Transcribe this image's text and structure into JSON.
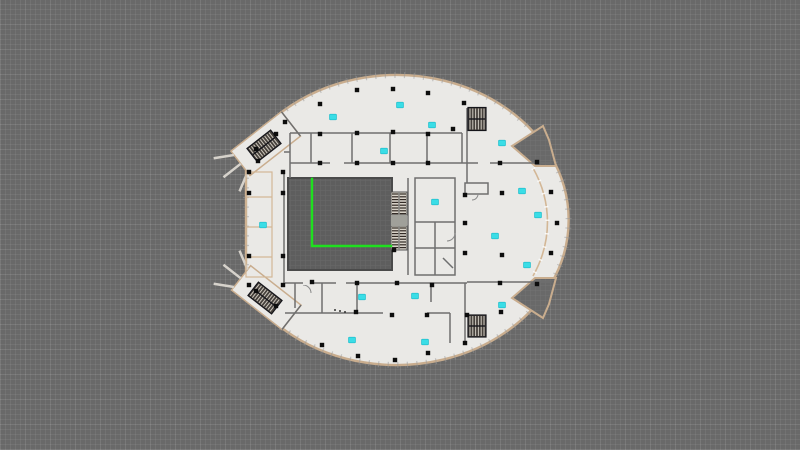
{
  "meta": {
    "view": "floor-plan-canvas",
    "description": "Elliptical building floor plan viewed top-down on a gray grid drafting canvas"
  },
  "colors": {
    "canvas_bg": "#696969",
    "grid_line": "#747474",
    "floor": "#eae9e6",
    "rim": "#c9ad8e",
    "wall": "#6f6f6f",
    "wall_dark": "#4e4e4e",
    "tan_room": "#d3b796",
    "void_fill": "#5e5e5e",
    "column": "#0d0d0d",
    "sensor": "#3adde6",
    "route": "#1fe01f",
    "stair_base": "#46413c",
    "stair_tread": "#cfc9bf",
    "escalator_base": "#d8d2c8",
    "escalator_tread": "#332b26",
    "landing": "#a0a09a",
    "tick": "#9a9a9a"
  },
  "building": {
    "cx": 397,
    "cy": 220,
    "rx": 172,
    "ry": 145,
    "chord": {
      "x": 246,
      "y1": 150,
      "y2": 290
    }
  },
  "atrium_void": {
    "x": 288,
    "y": 178,
    "w": 104,
    "h": 92
  },
  "route": {
    "points": [
      [
        312,
        179
      ],
      [
        312,
        246
      ],
      [
        391,
        246
      ]
    ]
  },
  "columns": [
    [
      320,
      104
    ],
    [
      357,
      90
    ],
    [
      393,
      89
    ],
    [
      428,
      93
    ],
    [
      464,
      103
    ],
    [
      285,
      122
    ],
    [
      453,
      129
    ],
    [
      320,
      134
    ],
    [
      357,
      133
    ],
    [
      393,
      132
    ],
    [
      428,
      134
    ],
    [
      258,
      161
    ],
    [
      256,
      149
    ],
    [
      276,
      134
    ],
    [
      320,
      163
    ],
    [
      357,
      163
    ],
    [
      393,
      163
    ],
    [
      428,
      163
    ],
    [
      500,
      163
    ],
    [
      537,
      162
    ],
    [
      249,
      172
    ],
    [
      283,
      172
    ],
    [
      249,
      193
    ],
    [
      283,
      193
    ],
    [
      249,
      256
    ],
    [
      283,
      256
    ],
    [
      465,
      195
    ],
    [
      502,
      193
    ],
    [
      551,
      192
    ],
    [
      465,
      223
    ],
    [
      557,
      223
    ],
    [
      394,
      250
    ],
    [
      465,
      253
    ],
    [
      502,
      255
    ],
    [
      551,
      253
    ],
    [
      256,
      291
    ],
    [
      276,
      306
    ],
    [
      249,
      285
    ],
    [
      283,
      285
    ],
    [
      312,
      282
    ],
    [
      357,
      283
    ],
    [
      397,
      283
    ],
    [
      432,
      285
    ],
    [
      500,
      283
    ],
    [
      537,
      284
    ],
    [
      356,
      312
    ],
    [
      392,
      315
    ],
    [
      427,
      315
    ],
    [
      467,
      315
    ],
    [
      501,
      312
    ],
    [
      322,
      345
    ],
    [
      358,
      356
    ],
    [
      395,
      360
    ],
    [
      465,
      343
    ],
    [
      428,
      353
    ]
  ],
  "sensors": [
    [
      333,
      117
    ],
    [
      400,
      105
    ],
    [
      432,
      125
    ],
    [
      384,
      151
    ],
    [
      502,
      143
    ],
    [
      522,
      191
    ],
    [
      538,
      215
    ],
    [
      435,
      202
    ],
    [
      495,
      236
    ],
    [
      527,
      265
    ],
    [
      263,
      225
    ],
    [
      362,
      297
    ],
    [
      415,
      296
    ],
    [
      502,
      305
    ],
    [
      352,
      340
    ],
    [
      425,
      342
    ]
  ],
  "escalators": {
    "x": 391,
    "w": 16,
    "blocks": [
      {
        "y": 192,
        "h": 23
      },
      {
        "y": 226,
        "h": 24
      }
    ],
    "landing": {
      "y": 215,
      "h": 11
    }
  },
  "stairs": [
    {
      "cx": 477,
      "cy": 119,
      "w": 18,
      "h": 23,
      "angle": 0
    },
    {
      "cx": 477,
      "cy": 326,
      "w": 18,
      "h": 22,
      "angle": 0
    },
    {
      "cx": 264,
      "cy": 146,
      "w": 30,
      "h": 17,
      "angle": -38
    },
    {
      "cx": 265,
      "cy": 298,
      "w": 30,
      "h": 17,
      "angle": 38
    }
  ],
  "notches": [
    [
      [
        543,
        126
      ],
      [
        512,
        146
      ],
      [
        535,
        166
      ],
      [
        556,
        166
      ],
      [
        549,
        140
      ]
    ],
    [
      [
        543,
        318
      ],
      [
        512,
        298
      ],
      [
        535,
        278
      ],
      [
        556,
        278
      ],
      [
        549,
        304
      ]
    ]
  ],
  "left_rooms": {
    "x": 246,
    "y": 172,
    "w": 26,
    "h": 105,
    "dividers_y": [
      197,
      227,
      257
    ]
  }
}
